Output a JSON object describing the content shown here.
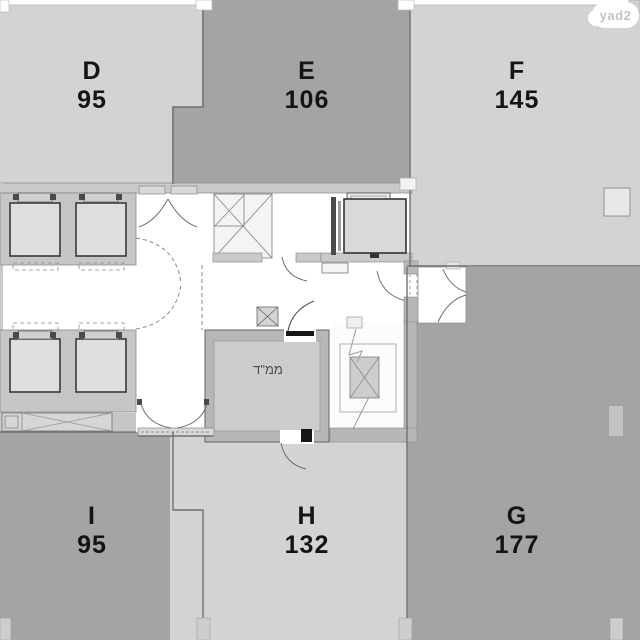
{
  "branding": {
    "logo": "yad2"
  },
  "units": [
    {
      "letter": "D",
      "area": "95"
    },
    {
      "letter": "E",
      "area": "106"
    },
    {
      "letter": "F",
      "area": "145"
    },
    {
      "letter": "G",
      "area": "177"
    },
    {
      "letter": "H",
      "area": "132"
    },
    {
      "letter": "I",
      "area": "95"
    }
  ],
  "rooms": {
    "safe_room_label": "ממ\"ד"
  },
  "colors": {
    "unit_light": "#d3d3d3",
    "unit_dark": "#a4a4a4",
    "walls": "#b7b7b7",
    "label_text": "#141414"
  }
}
